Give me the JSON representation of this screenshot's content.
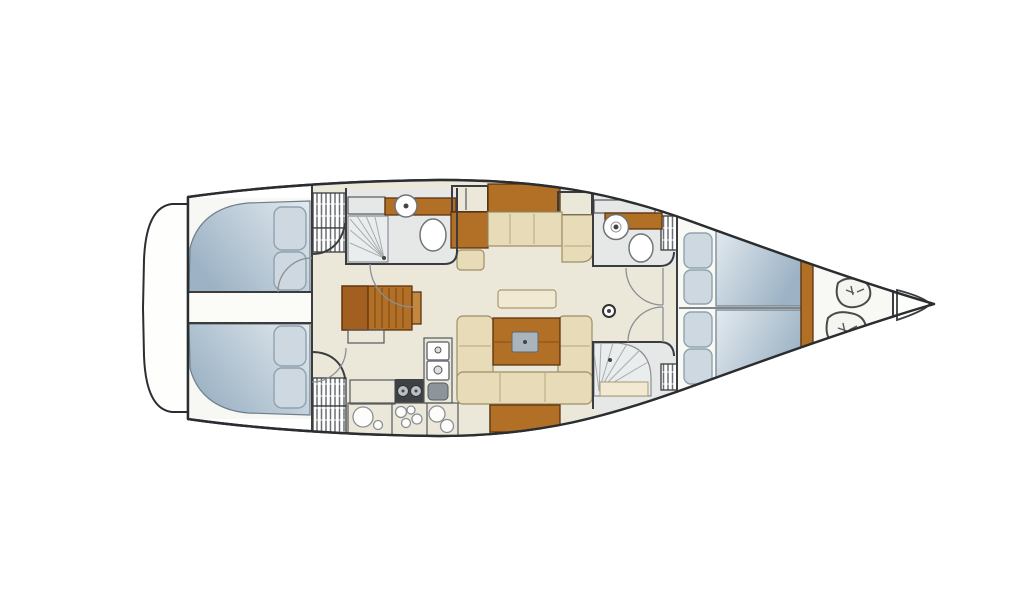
{
  "page": {
    "title": "Sailing yacht interior deck plan (bow to the right)",
    "background": "#ffffff"
  },
  "colors": {
    "hull_outline": "#2b2e30",
    "wall": "#3a3c3e",
    "deck": "#fbfbf8",
    "floor": "#ebe8da",
    "floor_cabin": "#f7f7f3",
    "floor_fwd": "#f8f8f4",
    "floor_head": "#e6e8e7",
    "wood": "#b26f26",
    "wood_dark": "#a35f1f",
    "wood_light": "#c48740",
    "cushion": "#e8dcb8",
    "cushion_light": "#f1e9d2",
    "berth_light": "#e3eaef",
    "berth_dark": "#9db3c5",
    "pillow": "#cdd8e0",
    "counter": "#a3aab0",
    "counter_dark": "#3e4245",
    "burner": "#b9bec2",
    "table_insert": "#aab4bd",
    "sailbag": "#f4f4f1",
    "white_panel": "#fcfcfa"
  },
  "boat": {
    "orientation": "bow-right",
    "compartments": [
      {
        "id": "swim-platform",
        "name": "stern swim platform"
      },
      {
        "id": "aft-cabin-port",
        "name": "aft double cabin (top) with berth and pillows"
      },
      {
        "id": "aft-cabin-starboard",
        "name": "aft double cabin (bottom) with berth and pillows"
      },
      {
        "id": "aft-head",
        "name": "aft head with shower, washbasin and toilet"
      },
      {
        "id": "companionway",
        "name": "companionway steps"
      },
      {
        "id": "galley",
        "name": "galley with stove, double sink and counters"
      },
      {
        "id": "saloon",
        "name": "saloon with U-settee and folding table"
      },
      {
        "id": "nav-settee",
        "name": "starboard settee with sideboard and stool"
      },
      {
        "id": "mast",
        "name": "mast foot"
      },
      {
        "id": "forward-head",
        "name": "forward head with washbasin and toilet"
      },
      {
        "id": "forward-shower",
        "name": "separate forward shower compartment"
      },
      {
        "id": "forward-cabin",
        "name": "forward V-berth owner cabin with pillows"
      },
      {
        "id": "sail-locker",
        "name": "bow sail locker with two sail bags"
      },
      {
        "id": "anchor-locker",
        "name": "anchor locker at bow tip"
      }
    ]
  }
}
